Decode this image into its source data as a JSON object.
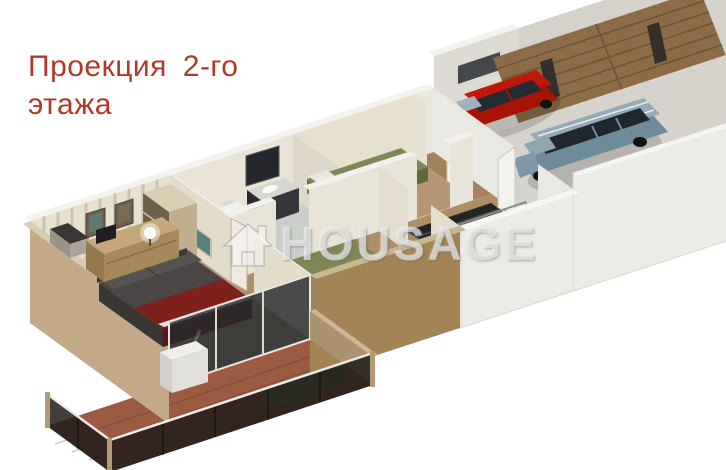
{
  "canvas": {
    "width": 726,
    "height": 470,
    "background": "#ffffff"
  },
  "title": {
    "line1": "Проекция 2-го",
    "line2": "этажа",
    "color": "#b5372a"
  },
  "watermark": {
    "text": "HOUSAGE",
    "icon": "house-icon",
    "color": "rgba(250,250,250,0.60)"
  },
  "scene": {
    "type": "isometric-3d-floorplan-render",
    "rooms": [
      "terrace",
      "master-bedroom",
      "bathroom",
      "single-bedroom",
      "kids-bedroom",
      "stair-hall",
      "garage"
    ],
    "objects": [
      "double-bed",
      "dresser",
      "table-lamp",
      "wall-pictures",
      "wardrobe",
      "bathtub",
      "toilet",
      "vanity",
      "mirror-cabinet",
      "single-bed",
      "twin-beds",
      "nightstand",
      "staircase",
      "stair-railing",
      "red-car",
      "blue-car",
      "garage-door",
      "terrace-railing",
      "chimney-vent",
      "hedge",
      "planter-box"
    ]
  },
  "colors": {
    "title_red": "#b5372a",
    "exterior_wall": "#c2aa89",
    "striped_wallpaper": "#e8e1cd",
    "interior_wall": "#e9e4d6",
    "wall_top": "#f3f1ea",
    "wood_floor": "#b89b72",
    "bedroom_floor": "#b29676",
    "tile_floor": "#cacfc9",
    "garage_floor": "#d6d3cd",
    "terrace_floor": "#9c5a43",
    "garage_door": "#8a6c48",
    "red_car": "#c0170b",
    "blue_car": "#6e8b9c",
    "maroon_bed": "#7e211d",
    "gray_bed": "#4a4645",
    "olive_bed": "#7f8657",
    "teal_tub": "#6fa7a4",
    "dark_glass": "#26221f",
    "stairwell": "#242424"
  }
}
